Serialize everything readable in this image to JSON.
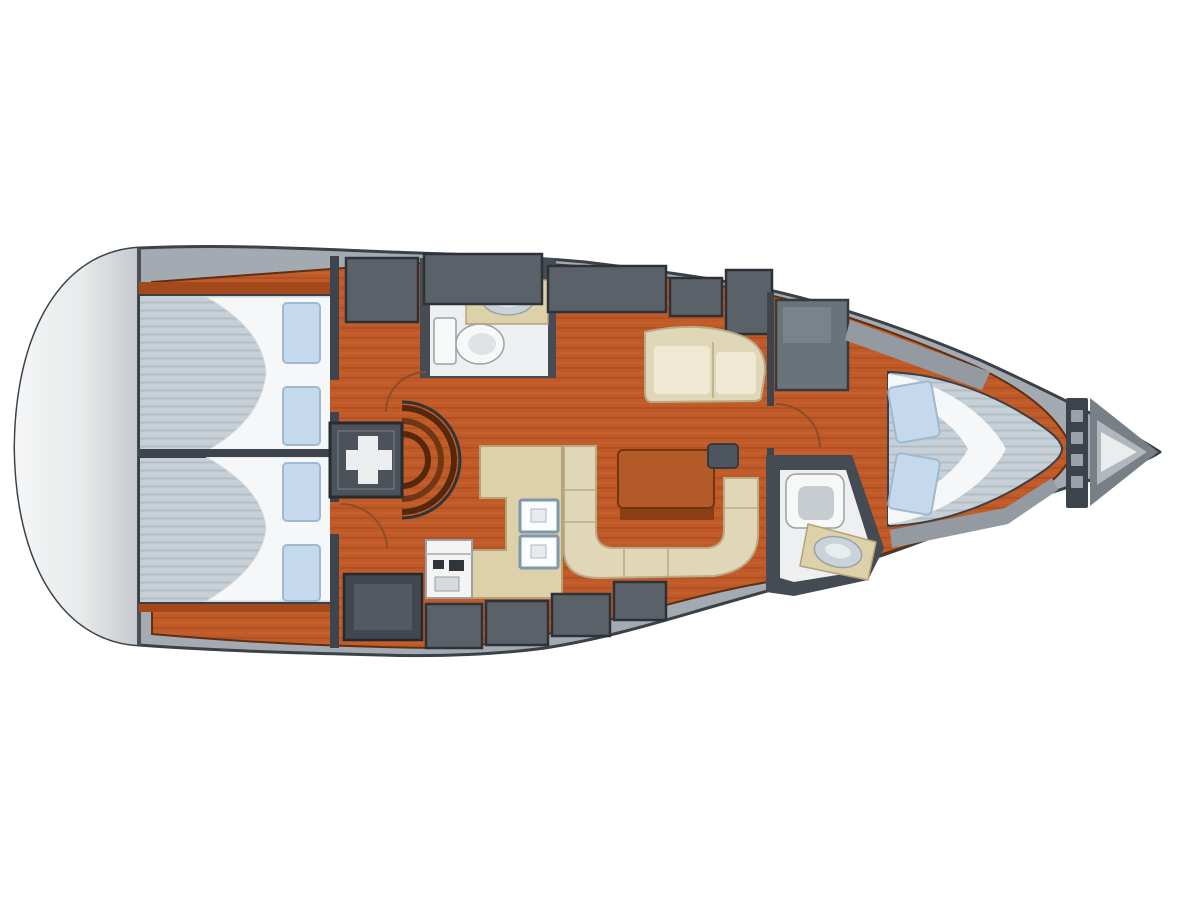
{
  "diagram": {
    "type": "yacht-interior-floor-plan",
    "description": "Top-down interior layout plan of a sailing yacht, bow to the right, stern to the left",
    "elements": [
      "hull-deck",
      "stern-swim-platform",
      "aft-cabin-port-berth",
      "aft-cabin-starboard-berth",
      "companionway-engine-box",
      "companionway-steps",
      "amidships-head-toilet",
      "amidships-head-sink",
      "port-settee",
      "dinette-u-settee",
      "saloon-table",
      "corner-seat",
      "galley-counter",
      "galley-double-sink",
      "galley-stove",
      "forward-head-toilet",
      "forward-head-sink",
      "forward-cabin-v-berth",
      "wardrobe-locker",
      "storage-lockers-top",
      "storage-lockers-bottom",
      "chain-locker-bulkhead",
      "anchor-locker",
      "bow-tip"
    ]
  },
  "colors": {
    "deck": "#a4aab1",
    "hull_outline": "#3a4147",
    "stern_light": "#f4f5f6",
    "stern_dark": "#c5c9cd",
    "floor": "#c05a28",
    "floor_streak": "#8e3d12",
    "trim": "#a3491c",
    "bulkhead": "#3d444b",
    "locker": "#5a6168",
    "locker_dark": "#40474e",
    "wardrobe": "#6b737a",
    "mattress": "#c7d0d6",
    "mattress_stripe": "#b0bcc4",
    "bedding": "#f6f7f8",
    "pillow": "#c5d9ec",
    "pillow_border": "#9fb9d2",
    "settee": "#e0d7b8",
    "settee_edge": "#b9ab84",
    "cushion_light": "#efe9d3",
    "table": "#b25a28",
    "table_border": "#73350f",
    "table_shadow": "#8a3e14",
    "counter": "#dcd1a9",
    "counter_edge": "#b3a377",
    "sink_white": "#fbfcfd",
    "sink_border": "#7f98ab",
    "fixture": "#f7f8f8",
    "fixture_border": "#9aa2a8",
    "fixture_inner": "#c6ccd0",
    "basin": "#c9d3d9",
    "head_floor": "#edeff0",
    "shelf": "#939aa1",
    "anchor_mid": "#787f86",
    "anchor_light": "#b1b7bc",
    "anchor_tip": "#eaecee",
    "steps_dark": "#55270b",
    "steps_mid": "#6f3712",
    "engine_box": "#4b525a",
    "symbol_white": "#eceeef",
    "door_arc": "#8a4f28",
    "background": "#ffffff"
  }
}
